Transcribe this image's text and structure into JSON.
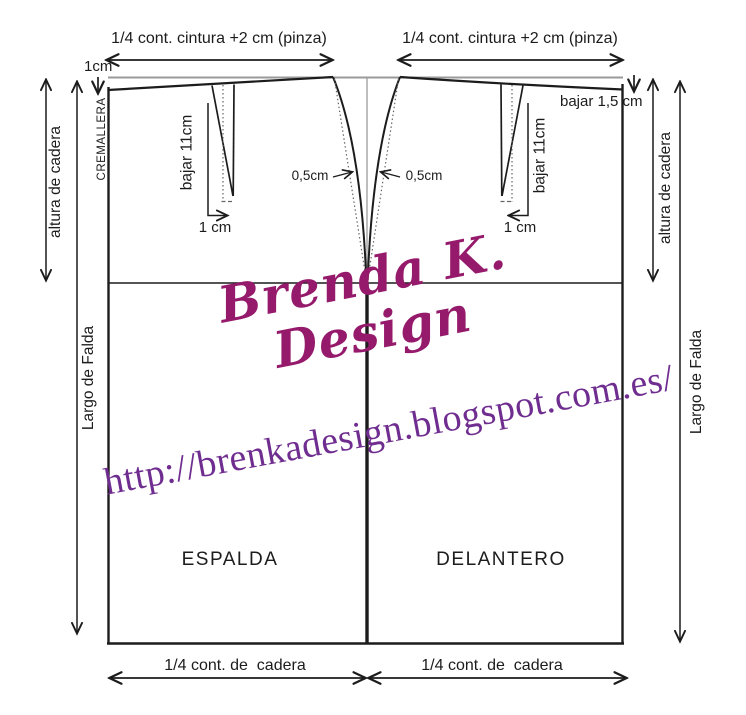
{
  "colors": {
    "line": "#1c1c1c",
    "construction_gray": "#9a9a9a",
    "signature_magenta": "#951a6b",
    "url_purple": "#6f2d90"
  },
  "top_section": {
    "back_waist_measure": "1/4 cont. cintura +2 cm (pinza)",
    "front_waist_measure": "1/4 cont. cintura +2 cm (pinza)",
    "back_waist_drop": "1cm",
    "front_waist_drop": "bajar 1,5 cm"
  },
  "left_edge": {
    "zipper": "CREMALLERA",
    "hip_height": "altura de cadera",
    "skirt_length": "Largo de Falda"
  },
  "right_edge": {
    "hip_height": "altura de cadera",
    "skirt_length": "Largo de Falda"
  },
  "darts": {
    "back_dart_depth": "bajar 11cm",
    "front_dart_depth": "bajar 11cm",
    "back_dart_width": "1 cm",
    "front_dart_width": "1 cm",
    "back_seam_curve": "0,5cm",
    "front_seam_curve": "0,5cm"
  },
  "pieces": {
    "back": "ESPALDA",
    "front": "DELANTERO"
  },
  "bottom_section": {
    "back_hip_measure": "1/4 cont. de  cadera",
    "front_hip_measure": "1/4 cont. de  cadera"
  },
  "watermark": {
    "signature": "Brenda K. Design",
    "url": "http://brenkadesign.blogspot.com.es/"
  }
}
